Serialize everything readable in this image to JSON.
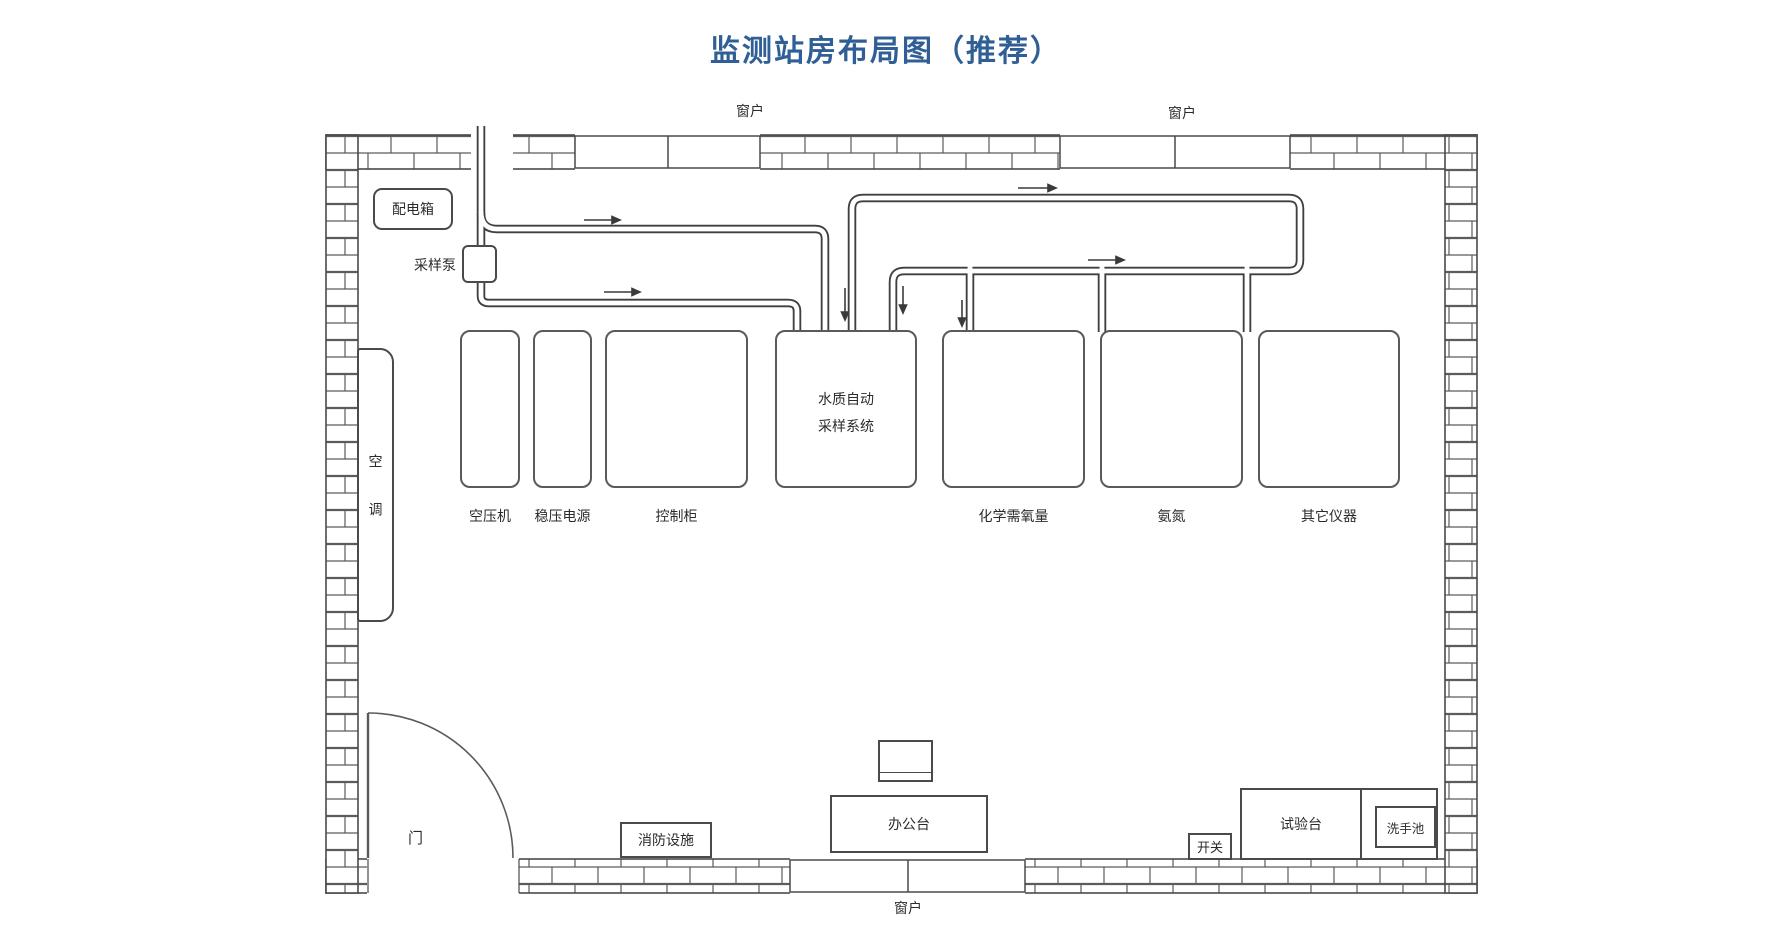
{
  "title": "监测站房布局图（推荐）",
  "colors": {
    "title": "#2f5f94",
    "line": "#4a4a4a"
  },
  "windows": {
    "top_left": "窗户",
    "top_right": "窗户",
    "bottom": "窗户"
  },
  "left_zone": {
    "distribution_box": "配电箱",
    "sampling_pump": "采样泵",
    "air_conditioner": "空调",
    "door": "门"
  },
  "equipment_row": [
    {
      "label": "空压机"
    },
    {
      "label": "稳压电源"
    },
    {
      "label": "控制柜"
    },
    {
      "label": "水质自动采样系统"
    },
    {
      "label": "化学需氧量"
    },
    {
      "label": "氨氮"
    },
    {
      "label": "其它仪器"
    }
  ],
  "furniture": {
    "fire_equipment": "消防设施",
    "office_desk": "办公台",
    "switch": "开关",
    "test_bench": "试验台",
    "wash_basin": "洗手池"
  }
}
